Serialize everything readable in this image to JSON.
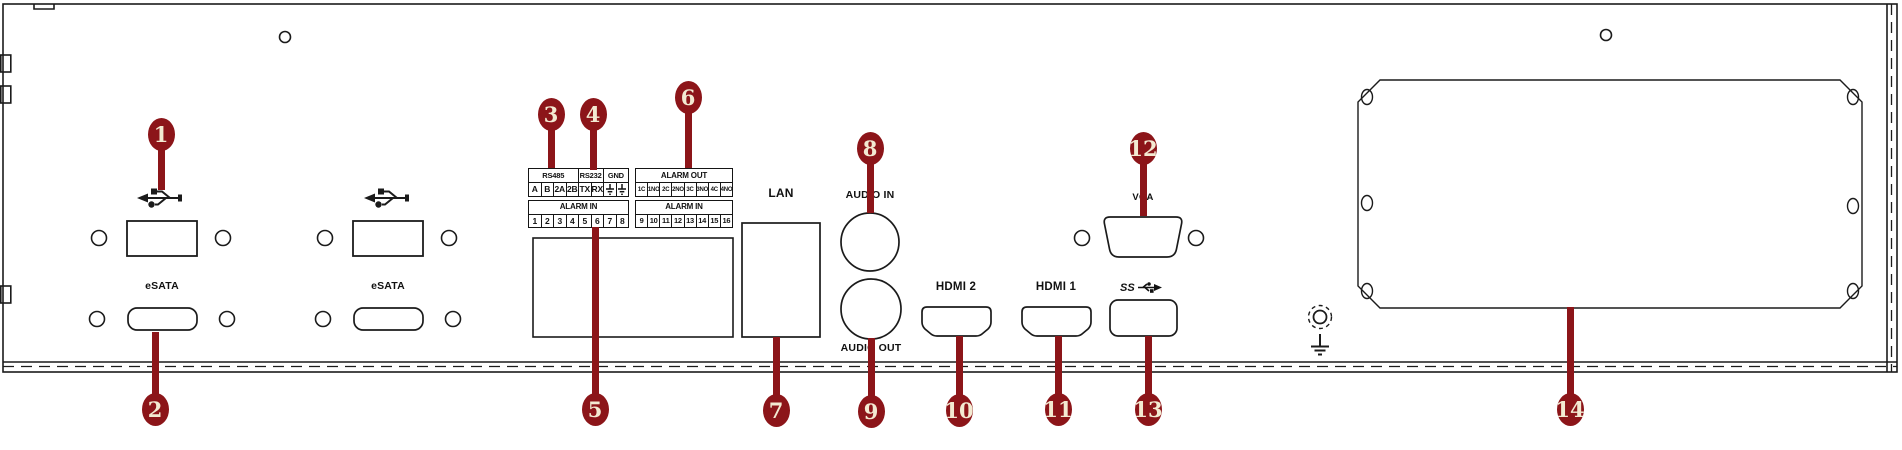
{
  "diagram": {
    "title": "DVR rear panel interface diagram",
    "callout_color": "#8c1519",
    "callout_text_color": "#f3ead2",
    "line_color": "#1b1b1b"
  },
  "labels": {
    "esata_left": "eSATA",
    "esata_right": "eSATA",
    "lan": "LAN",
    "audio_in": "AUDIO IN",
    "audio_out": "AUDIO OUT",
    "hdmi_2": "HDMI 2",
    "hdmi_1": "HDMI 1",
    "vga": "VGA",
    "usb3_ss": "SS"
  },
  "icons": {
    "usb": "usb-trident-icon",
    "usb3": "usb3-superspeed-icon",
    "ground_screw": "ground-screw-icon",
    "earth_ground": "earth-ground-icon",
    "gnd_pin": "ground-pin-icon"
  },
  "terminal_blocks": [
    {
      "id": "serial",
      "x": 528,
      "y": 168,
      "w": 101,
      "h": 29,
      "head_font": 7.5,
      "pin_font": 8.5,
      "groups": [
        {
          "label": "RS485",
          "span": 4
        },
        {
          "label": "RS232",
          "span": 2
        },
        {
          "label": "GND",
          "span": 2
        }
      ],
      "pins": [
        "A",
        "B",
        "2A",
        "2B",
        "TX",
        "RX",
        "⏚",
        "⏚"
      ]
    },
    {
      "id": "alarm-out",
      "x": 635,
      "y": 168,
      "w": 98,
      "h": 29,
      "head_font": 8,
      "pin_font": 6,
      "groups": [
        {
          "label": "ALARM OUT",
          "span": 8
        }
      ],
      "pins": [
        "1C",
        "1NO",
        "2C",
        "2NO",
        "3C",
        "3NO",
        "4C",
        "4NO"
      ]
    },
    {
      "id": "alarm-in-1",
      "x": 528,
      "y": 200,
      "w": 101,
      "h": 28,
      "head_font": 8,
      "pin_font": 8.5,
      "groups": [
        {
          "label": "ALARM IN",
          "span": 8
        }
      ],
      "pins": [
        "1",
        "2",
        "3",
        "4",
        "5",
        "6",
        "7",
        "8"
      ]
    },
    {
      "id": "alarm-in-2",
      "x": 635,
      "y": 200,
      "w": 98,
      "h": 28,
      "head_font": 8,
      "pin_font": 7.5,
      "groups": [
        {
          "label": "ALARM IN",
          "span": 8
        }
      ],
      "pins": [
        "9",
        "10",
        "11",
        "12",
        "13",
        "14",
        "15",
        "16"
      ]
    }
  ],
  "callouts": [
    {
      "num": "1",
      "cx": 161,
      "cy": 134,
      "sx": 161,
      "sy1": 146,
      "sy2": 190
    },
    {
      "num": "2",
      "cx": 155,
      "cy": 409,
      "sx": 155,
      "sy1": 332,
      "sy2": 396
    },
    {
      "num": "3",
      "cx": 551,
      "cy": 114,
      "sx": 551,
      "sy1": 126,
      "sy2": 168
    },
    {
      "num": "4",
      "cx": 593,
      "cy": 114,
      "sx": 593,
      "sy1": 126,
      "sy2": 170
    },
    {
      "num": "5",
      "cx": 595,
      "cy": 409,
      "sx": 595,
      "sy1": 227,
      "sy2": 396
    },
    {
      "num": "6",
      "cx": 688,
      "cy": 97,
      "sx": 688,
      "sy1": 109,
      "sy2": 168
    },
    {
      "num": "7",
      "cx": 776,
      "cy": 410,
      "sx": 776,
      "sy1": 337,
      "sy2": 397
    },
    {
      "num": "8",
      "cx": 870,
      "cy": 148,
      "sx": 870,
      "sy1": 160,
      "sy2": 213
    },
    {
      "num": "9",
      "cx": 871,
      "cy": 411,
      "sx": 871,
      "sy1": 338,
      "sy2": 398
    },
    {
      "num": "10",
      "cx": 959,
      "cy": 410,
      "sx": 959,
      "sy1": 336,
      "sy2": 397
    },
    {
      "num": "11",
      "cx": 1058,
      "cy": 409,
      "sx": 1058,
      "sy1": 336,
      "sy2": 396
    },
    {
      "num": "12",
      "cx": 1143,
      "cy": 148,
      "sx": 1143,
      "sy1": 160,
      "sy2": 216
    },
    {
      "num": "13",
      "cx": 1148,
      "cy": 409,
      "sx": 1148,
      "sy1": 336,
      "sy2": 396
    },
    {
      "num": "14",
      "cx": 1570,
      "cy": 409,
      "sx": 1570,
      "sy1": 307,
      "sy2": 396
    }
  ]
}
